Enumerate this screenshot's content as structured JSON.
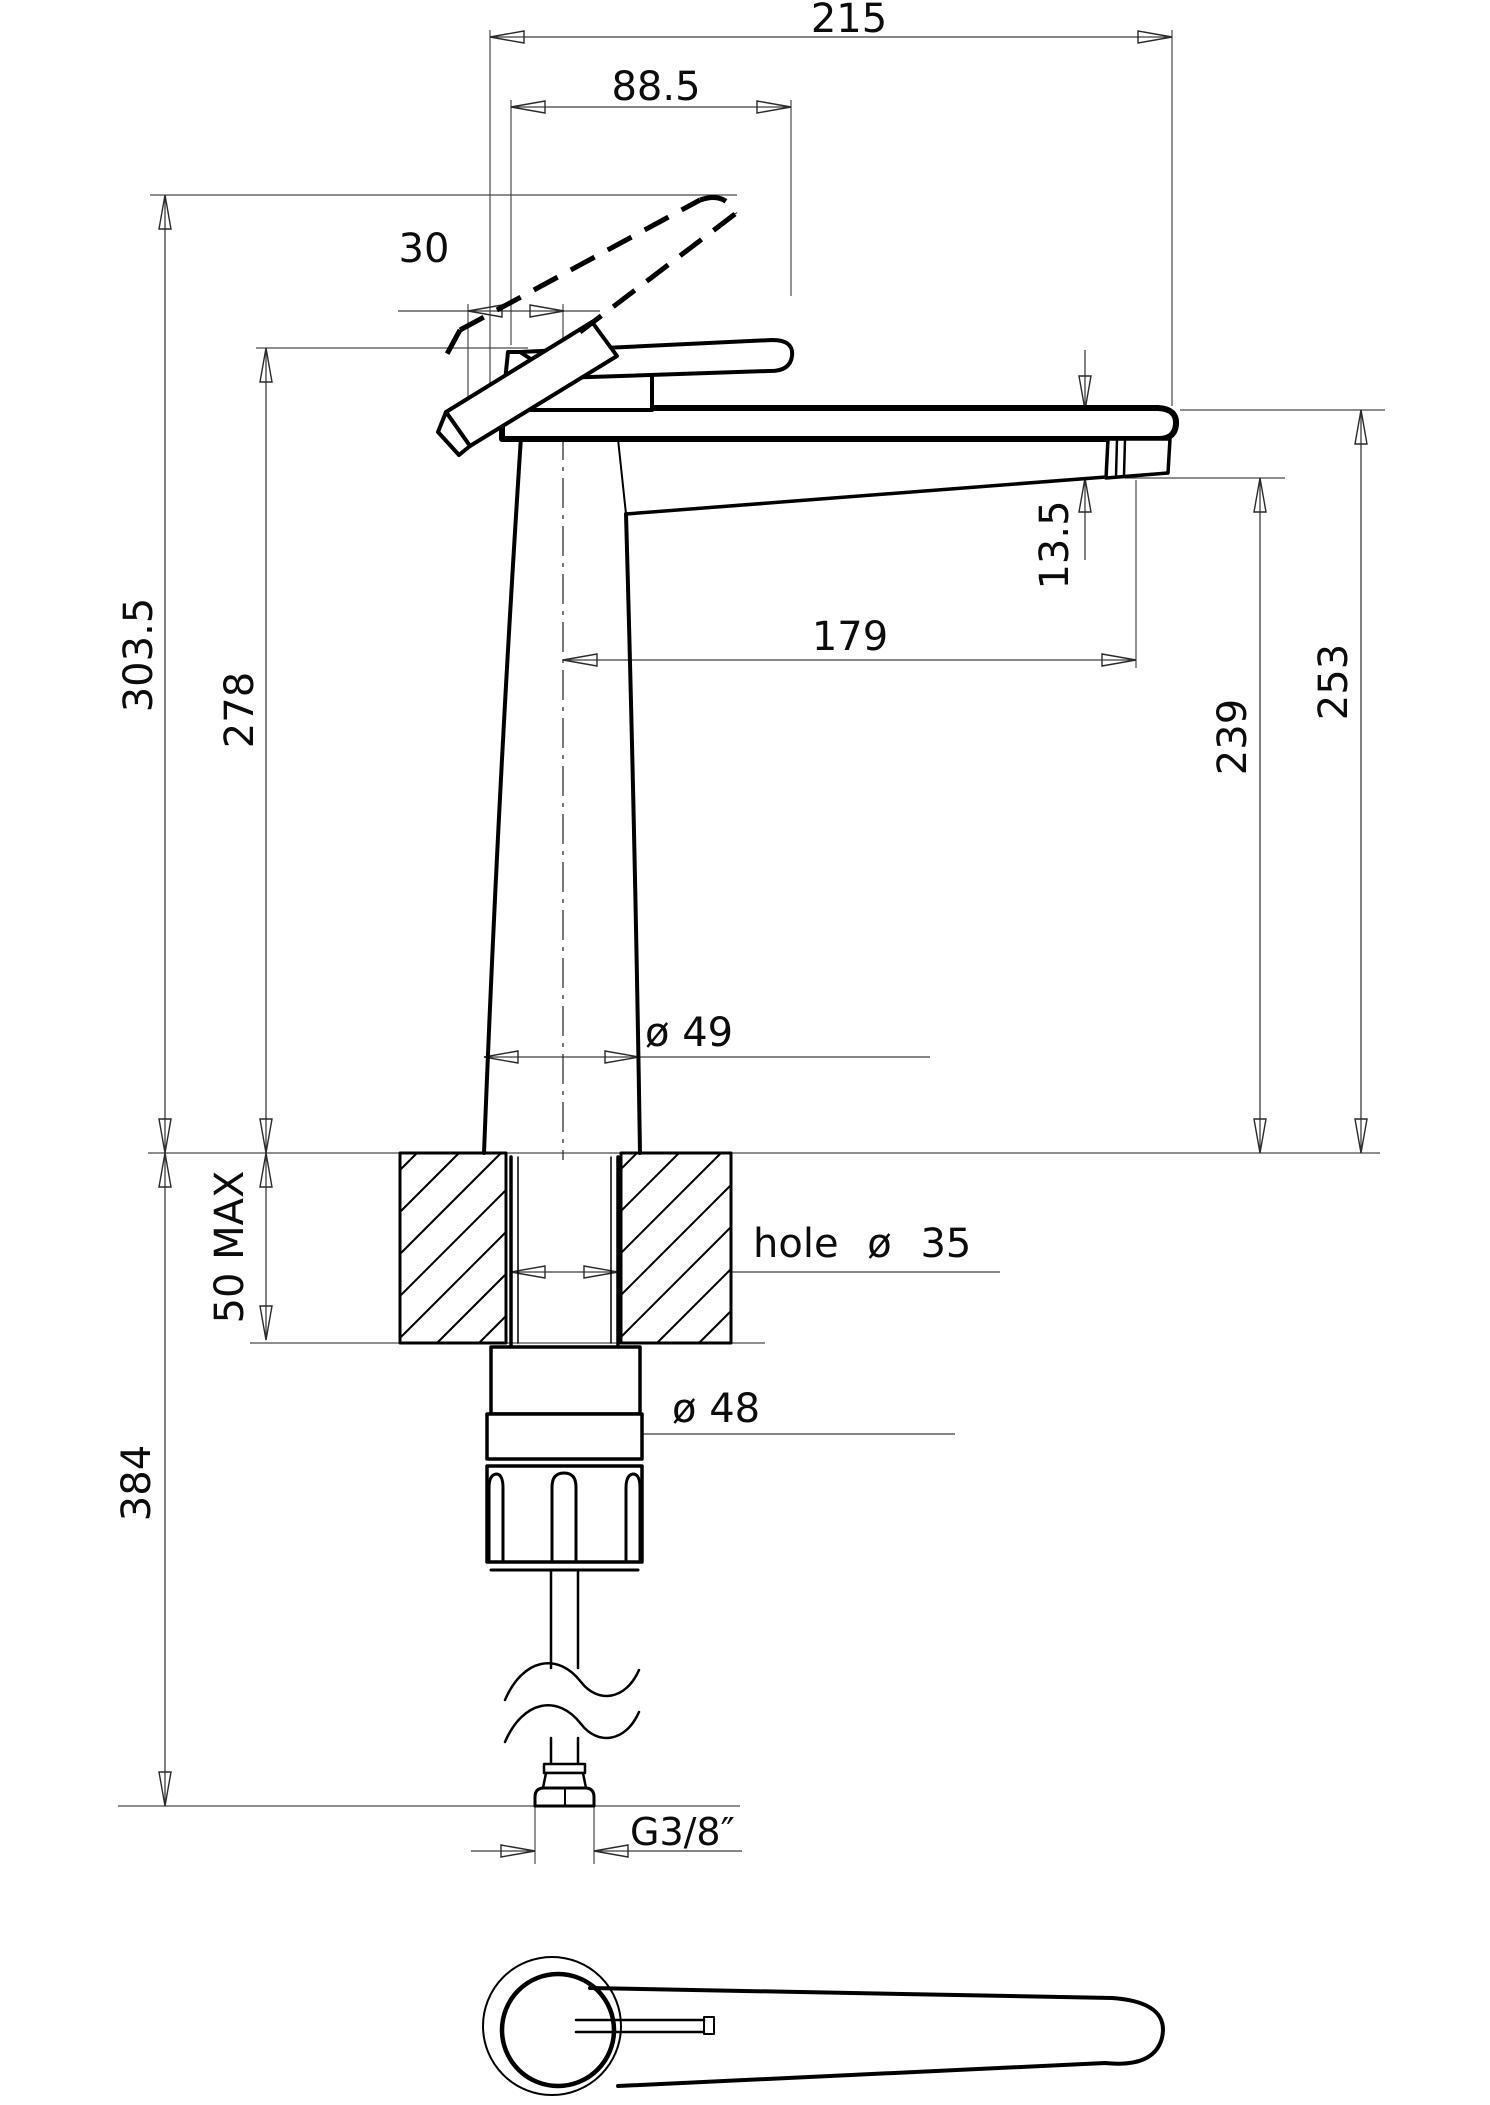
{
  "drawing": {
    "type": "technical-dimension-drawing",
    "subject": "single-lever tall basin/kitchen mixer tap, side elevation with mounting section and plan view of handle",
    "units": "mm",
    "line_color": "#000000",
    "background": "#ffffff",
    "labels": {
      "total_reach": "215",
      "handle_projection": "88.5",
      "handle_offset": "30",
      "spout_end_drop": "13.5",
      "spout_reach": "179",
      "height_handle_open": "303.5",
      "height_handle_closed": "278",
      "spout_top_height": "253",
      "spout_underside_height": "239",
      "body_diameter": "ø 49",
      "hole_note": "hole ø 35",
      "deck_thickness_max": "50 MAX",
      "under_deck_length": "384",
      "nut_diameter": "ø 48",
      "thread": "G3/8″"
    }
  }
}
